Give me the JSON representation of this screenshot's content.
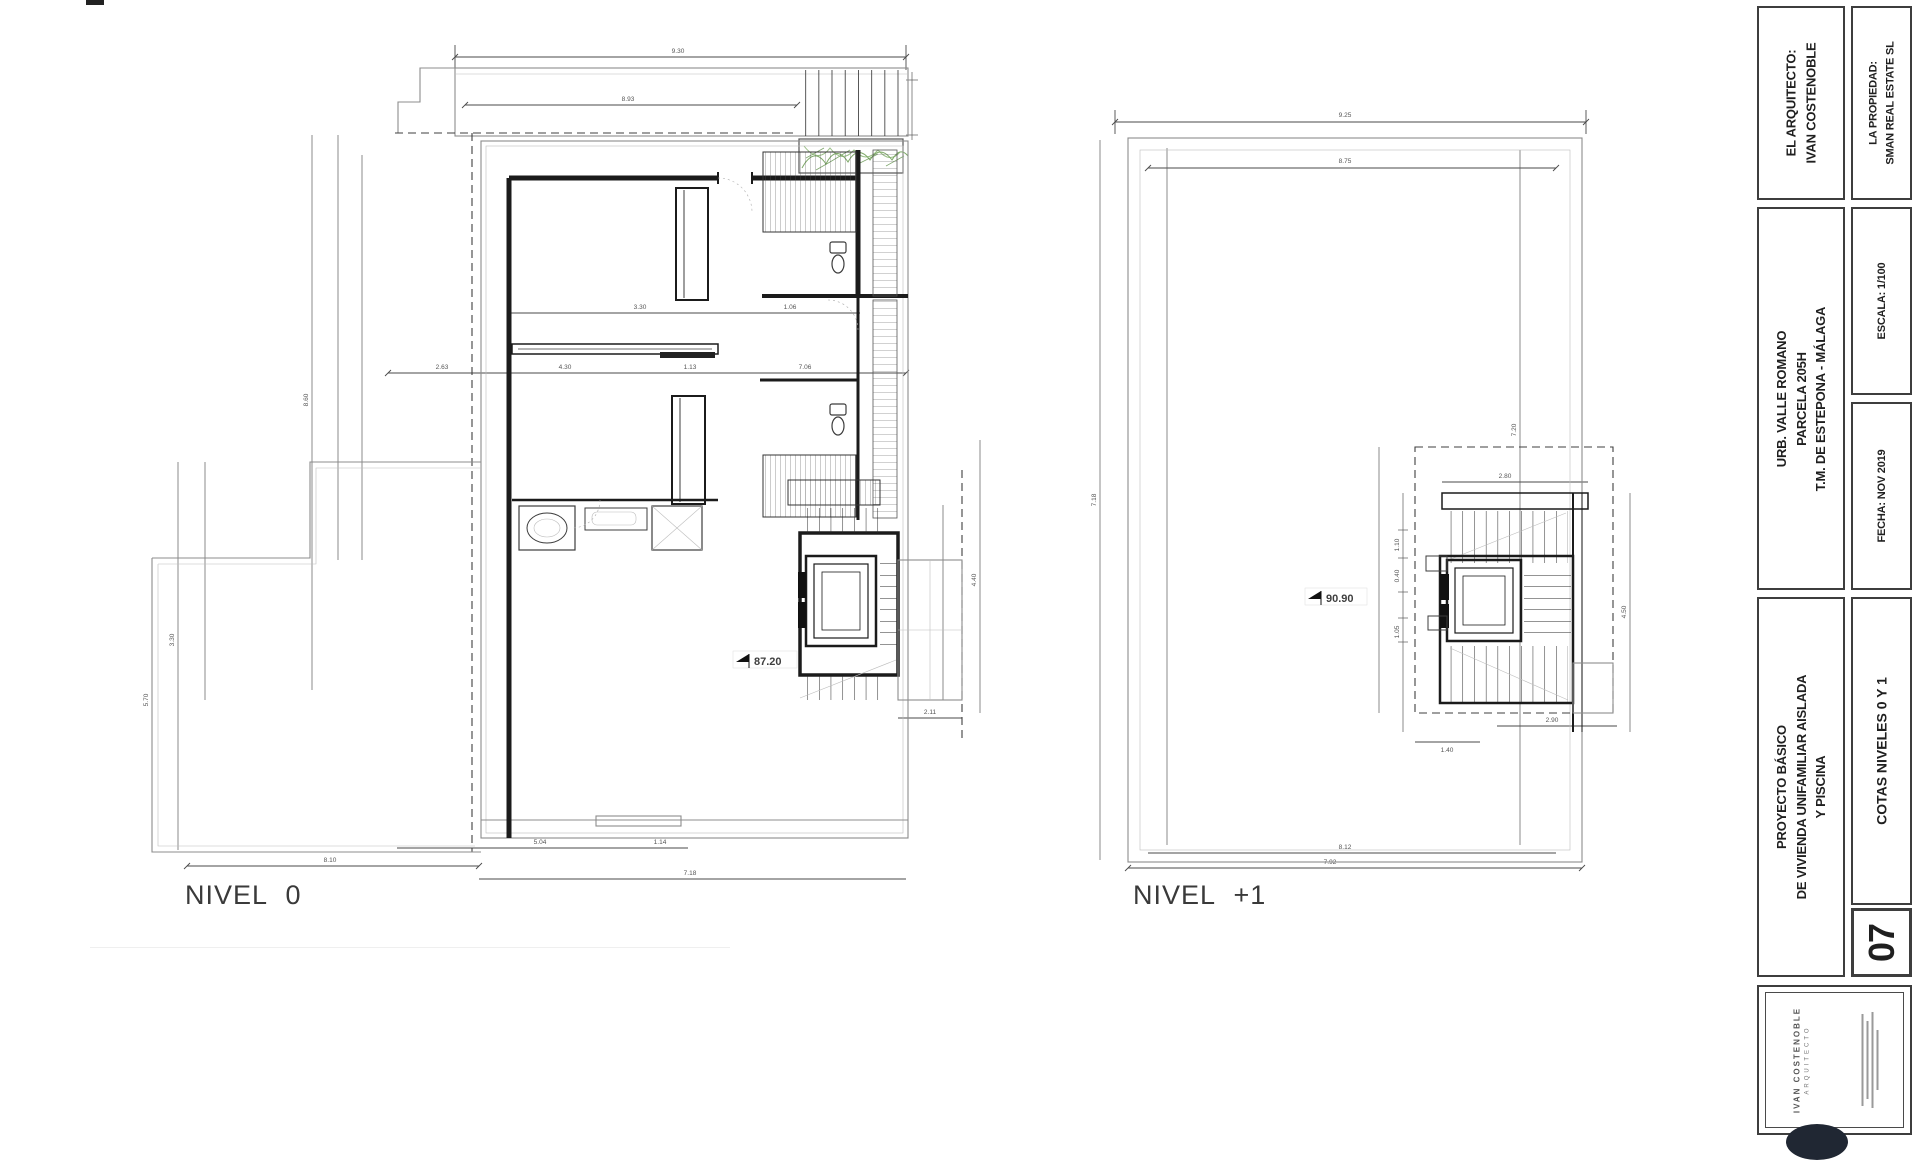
{
  "labels": {
    "nivel0": "NIVEL 0",
    "nivel1": "NIVEL +1"
  },
  "markers": {
    "nivel0_elevation": "87.20",
    "nivel1_elevation": "90.90"
  },
  "dims0": {
    "d1": "9.30",
    "d2": "8.93",
    "d3": "2.63",
    "d4": "4.30",
    "d5": "1.13",
    "d6": "7.06",
    "d7": "3.30",
    "d8": "1.06",
    "d9": "5.04",
    "d10": "1.14",
    "d11": "8.10",
    "d12": "7.18",
    "d13": "2.11",
    "d14": "4.40",
    "d15": "8.60",
    "d16": "5.70",
    "d17": "3.30"
  },
  "dims1": {
    "d1": "9.25",
    "d2": "8.75",
    "d3": "7.18",
    "d4": "7.20",
    "d5": "2.80",
    "d6": "4.50",
    "d7": "2.90",
    "d8": "1.40",
    "d9": "8.12",
    "d10": "7.92",
    "d11": "1.10",
    "d12": "0.40",
    "d13": "1.05"
  },
  "title_block": {
    "architect_label": "EL ARQUITECTO:",
    "architect_name": "IVAN COSTENOBLE",
    "owner_label": "LA PROPIEDAD:",
    "owner_name": "SMAN REAL ESTATE SL",
    "location_line1": "URB. VALLE ROMANO",
    "location_line2": "PARCELA 205H",
    "location_line3": "T.M. DE ESTEPONA - MÁLAGA",
    "scale": "ESCALA: 1/100",
    "date": "FECHA: NOV 2019",
    "project_line1": "PROYECTO BÁSICO",
    "project_line2": "DE VIVIENDA UNIFAMILIAR AISLADA",
    "project_line3": "Y PISCINA",
    "sheet_title": "COTAS NIVELES 0 Y 1",
    "sheet_number": "07",
    "stamp_name": "IVAN COSTENOBLE",
    "stamp_role": "ARQUITECTO"
  }
}
